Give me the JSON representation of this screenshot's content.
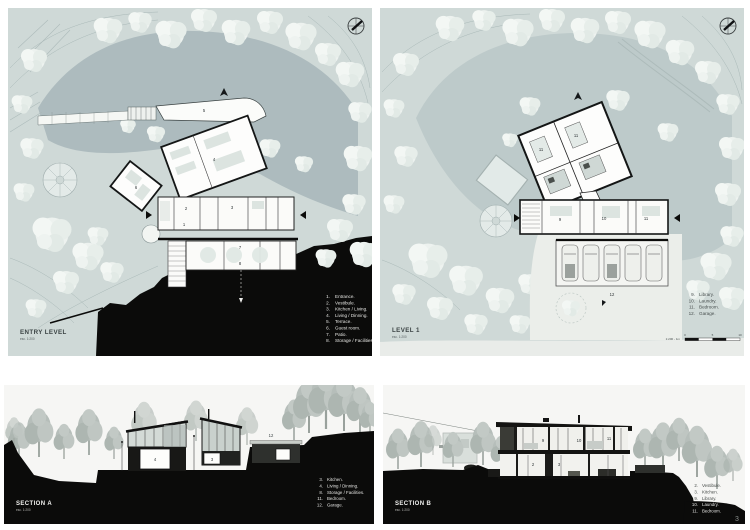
{
  "colors": {
    "site_light": "#cfd9d7",
    "site_dark": "#adbbbe",
    "site_mid": "#bdcaca",
    "tree_white": "#edf2ef",
    "terrain_black": "#0b0b0a",
    "section_sky": "#f6f6f4",
    "section_tree": "#b6beba",
    "drive_light": "#ebeeea",
    "text_dark": "#3c4445",
    "text_light": "#e6e6e3"
  },
  "entry_level": {
    "title": "ENTRY LEVEL",
    "scale": "esc. 1:200",
    "legend": [
      {
        "n": "1.",
        "t": "Entrance."
      },
      {
        "n": "2.",
        "t": "Vestibule."
      },
      {
        "n": "3.",
        "t": "Kitchen / Living."
      },
      {
        "n": "4.",
        "t": "Living / Dinning."
      },
      {
        "n": "5.",
        "t": "Terrace."
      },
      {
        "n": "6.",
        "t": "Guest room."
      },
      {
        "n": "7.",
        "t": "Patio."
      },
      {
        "n": "8.",
        "t": "Storage / Facilities."
      }
    ],
    "rooms": {
      "n1": "1",
      "n2": "2",
      "n3": "3",
      "n4": "4",
      "n5": "5",
      "n6": "6",
      "n7": "7",
      "n8": "8"
    }
  },
  "level_1": {
    "title": "LEVEL 1",
    "scale": "esc. 1:200",
    "legend": [
      {
        "n": "9.",
        "t": "Library."
      },
      {
        "n": "10.",
        "t": "Laundry."
      },
      {
        "n": "11.",
        "t": "Bedroom."
      },
      {
        "n": "12.",
        "t": "Garage."
      }
    ],
    "rooms": {
      "b1": "11",
      "b2": "11",
      "lib": "9",
      "lau": "10",
      "bed": "11",
      "gar": "12"
    },
    "scalebar": {
      "caption": "1:200 - 1m",
      "t0": "0",
      "t5": "5",
      "t10": "10"
    }
  },
  "section_a": {
    "title": "SECTION A",
    "scale": "esc. 1:200",
    "legend": [
      {
        "n": "3.",
        "t": "Kitchen."
      },
      {
        "n": "4.",
        "t": "Living / Dinning."
      },
      {
        "n": "8.",
        "t": "Storage / Facilities."
      },
      {
        "n": "11.",
        "t": "Bedroom."
      },
      {
        "n": "12.",
        "t": "Garage."
      }
    ],
    "rooms": {
      "liv": "4",
      "kit": "3",
      "gar": "12"
    }
  },
  "section_b": {
    "title": "SECTION B",
    "scale": "esc. 1:200",
    "legend": [
      {
        "n": "2.",
        "t": "Vestibule."
      },
      {
        "n": "3.",
        "t": "Kitchen."
      },
      {
        "n": "9.",
        "t": "Library."
      },
      {
        "n": "10.",
        "t": "Laundry."
      },
      {
        "n": "11.",
        "t": "Bedroom."
      }
    ],
    "rooms": {
      "ves": "2",
      "kit": "3",
      "lib": "9",
      "lau": "10",
      "bed": "11"
    },
    "page": "3"
  }
}
